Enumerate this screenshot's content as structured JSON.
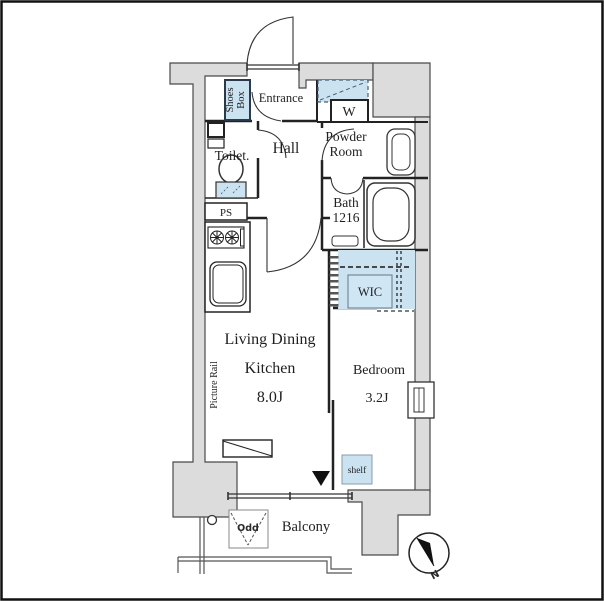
{
  "title": "apartment-floorplan",
  "colors": {
    "wall_fill": "#dcdcdc",
    "accent_blue": "#cbe2f1",
    "line": "#333333",
    "border": "#111111"
  },
  "labels": {
    "shoes_line1": "Shoes",
    "shoes_line2": "Box",
    "entrance": "Entrance",
    "washer": "W",
    "toilet": "Toilet.",
    "hall": "Hall",
    "powder_line1": "Powder",
    "powder_line2": "Room",
    "bath_line1": "Bath",
    "bath_line2": "1216",
    "ps": "PS",
    "wic": "WIC",
    "ldk_line1": "Living Dining",
    "ldk_line2": "Kitchen",
    "ldk_size": "8.0J",
    "bedroom": "Bedroom",
    "bedroom_size": "3.2J",
    "picture_rail": "Picture Rail",
    "shelf": "shelf",
    "balcony": "Balcony",
    "odd_marker": "Odd",
    "compass_north": "N"
  }
}
